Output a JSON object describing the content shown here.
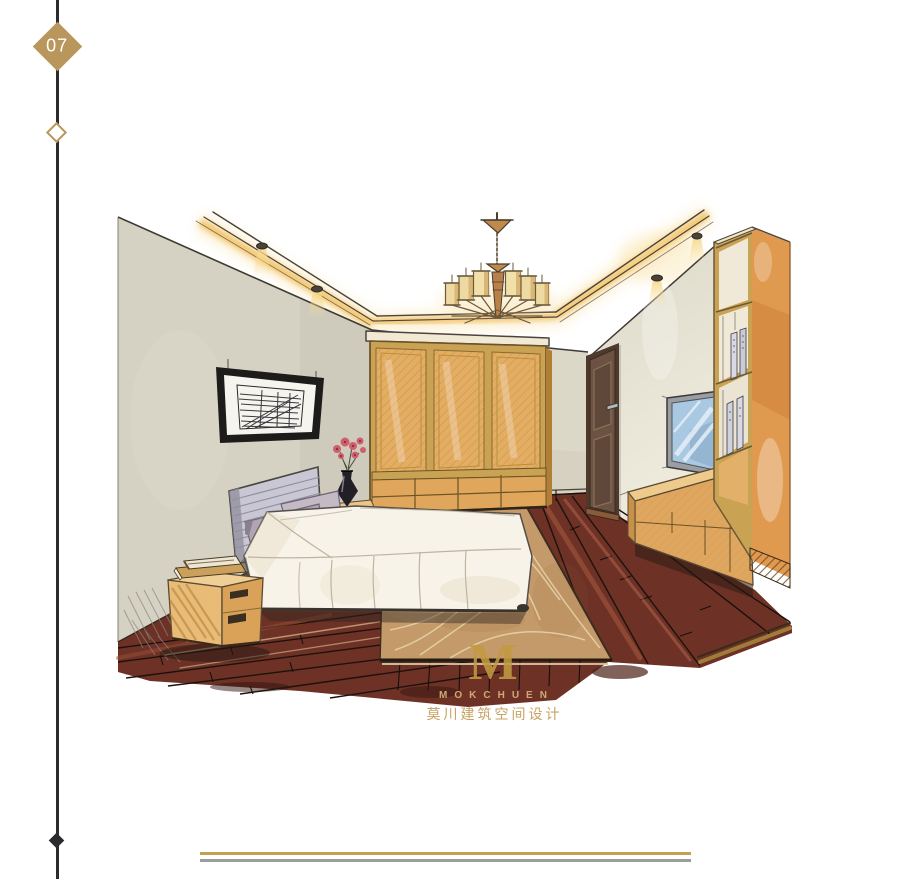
{
  "page": {
    "number": "07"
  },
  "brand": {
    "monogram": "M",
    "name_en": "MOKCHUEN",
    "name_zh": "莫川建筑空间设计"
  },
  "colors": {
    "accent_gold": "#b9975c",
    "logo_gold": "#c29b42",
    "rail_dark": "#2b2b2d",
    "footer_gold": "#c2a150",
    "footer_gray": "#9c9c9c",
    "wall_beige": "#d6d2c3",
    "wood_tan": "#e0a95f",
    "floor_brown": "#6e3126",
    "rug_tan": "#c59a6a",
    "cove_glow": "#f2c express",
    "glow_yellow": "#f2bf5e",
    "duvet_white": "#f7f3e9",
    "headboard_gray": "#c9c7d4",
    "door_brown": "#6b5243",
    "tv_screen_blue": "#a9c8e2"
  },
  "illustration": {
    "kind": "hand-drawn marker rendering",
    "subject": "bedroom interior with cove-lit ceiling, chandelier, wardrobe, bed, nightstand, TV wall, bookshelf and wood floor with rug",
    "elements": [
      "cove-lighting",
      "ceiling-tray",
      "chandelier",
      "ceiling-spotlights",
      "left-wall",
      "wall-art",
      "back-wall",
      "right-wall",
      "door",
      "wardrobe",
      "tv",
      "tv-console",
      "bookshelf",
      "wood-floor",
      "area-rug",
      "bed",
      "pillows",
      "duvet",
      "bedside-table",
      "vase-with-flowers",
      "nightstand",
      "stacked-books"
    ]
  }
}
